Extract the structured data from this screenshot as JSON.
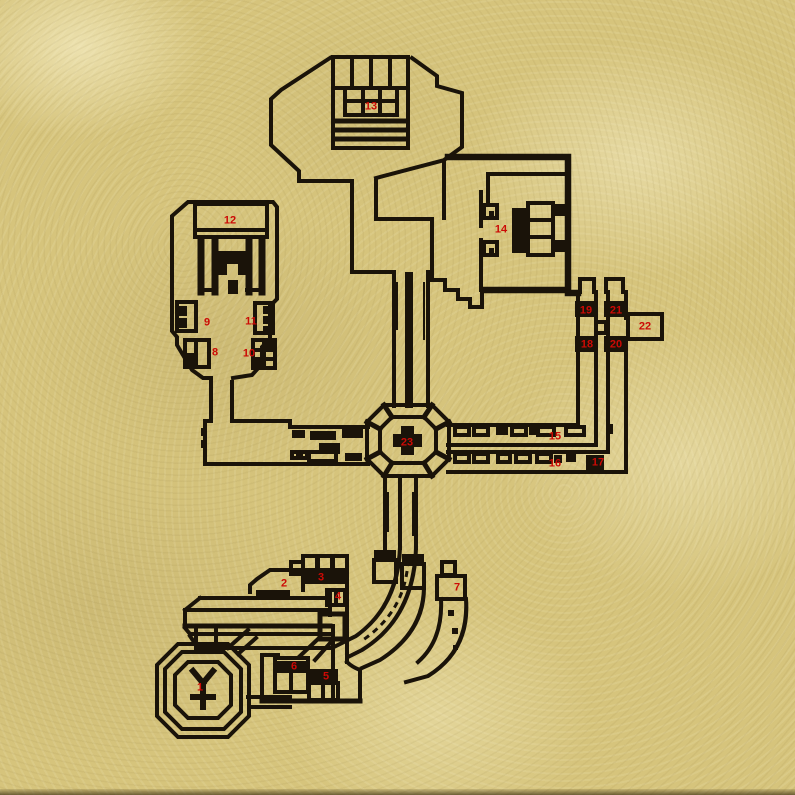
{
  "map": {
    "colors": {
      "parchment": "#d6c47c",
      "parchment_light": "#e9dda6",
      "parchment_dark": "#b9a663",
      "ink": "#1a1309",
      "marker_red": "#cc0a05"
    },
    "markers": [
      {
        "label": "1",
        "x": 200,
        "y": 688
      },
      {
        "label": "2",
        "x": 284,
        "y": 584
      },
      {
        "label": "3",
        "x": 321,
        "y": 578
      },
      {
        "label": "4",
        "x": 338,
        "y": 597
      },
      {
        "label": "5",
        "x": 326,
        "y": 677
      },
      {
        "label": "6",
        "x": 294,
        "y": 667
      },
      {
        "label": "7",
        "x": 457,
        "y": 588
      },
      {
        "label": "8",
        "x": 215,
        "y": 353
      },
      {
        "label": "9",
        "x": 207,
        "y": 323
      },
      {
        "label": "10",
        "x": 249,
        "y": 354
      },
      {
        "label": "11",
        "x": 251,
        "y": 322
      },
      {
        "label": "12",
        "x": 230,
        "y": 221
      },
      {
        "label": "13",
        "x": 371,
        "y": 107
      },
      {
        "label": "14",
        "x": 501,
        "y": 230
      },
      {
        "label": "15",
        "x": 555,
        "y": 437
      },
      {
        "label": "16",
        "x": 555,
        "y": 464
      },
      {
        "label": "17",
        "x": 598,
        "y": 463
      },
      {
        "label": "18",
        "x": 587,
        "y": 345
      },
      {
        "label": "19",
        "x": 586,
        "y": 311
      },
      {
        "label": "20",
        "x": 616,
        "y": 345
      },
      {
        "label": "21",
        "x": 616,
        "y": 311
      },
      {
        "label": "22",
        "x": 645,
        "y": 327
      },
      {
        "label": "23",
        "x": 407,
        "y": 443
      }
    ]
  }
}
